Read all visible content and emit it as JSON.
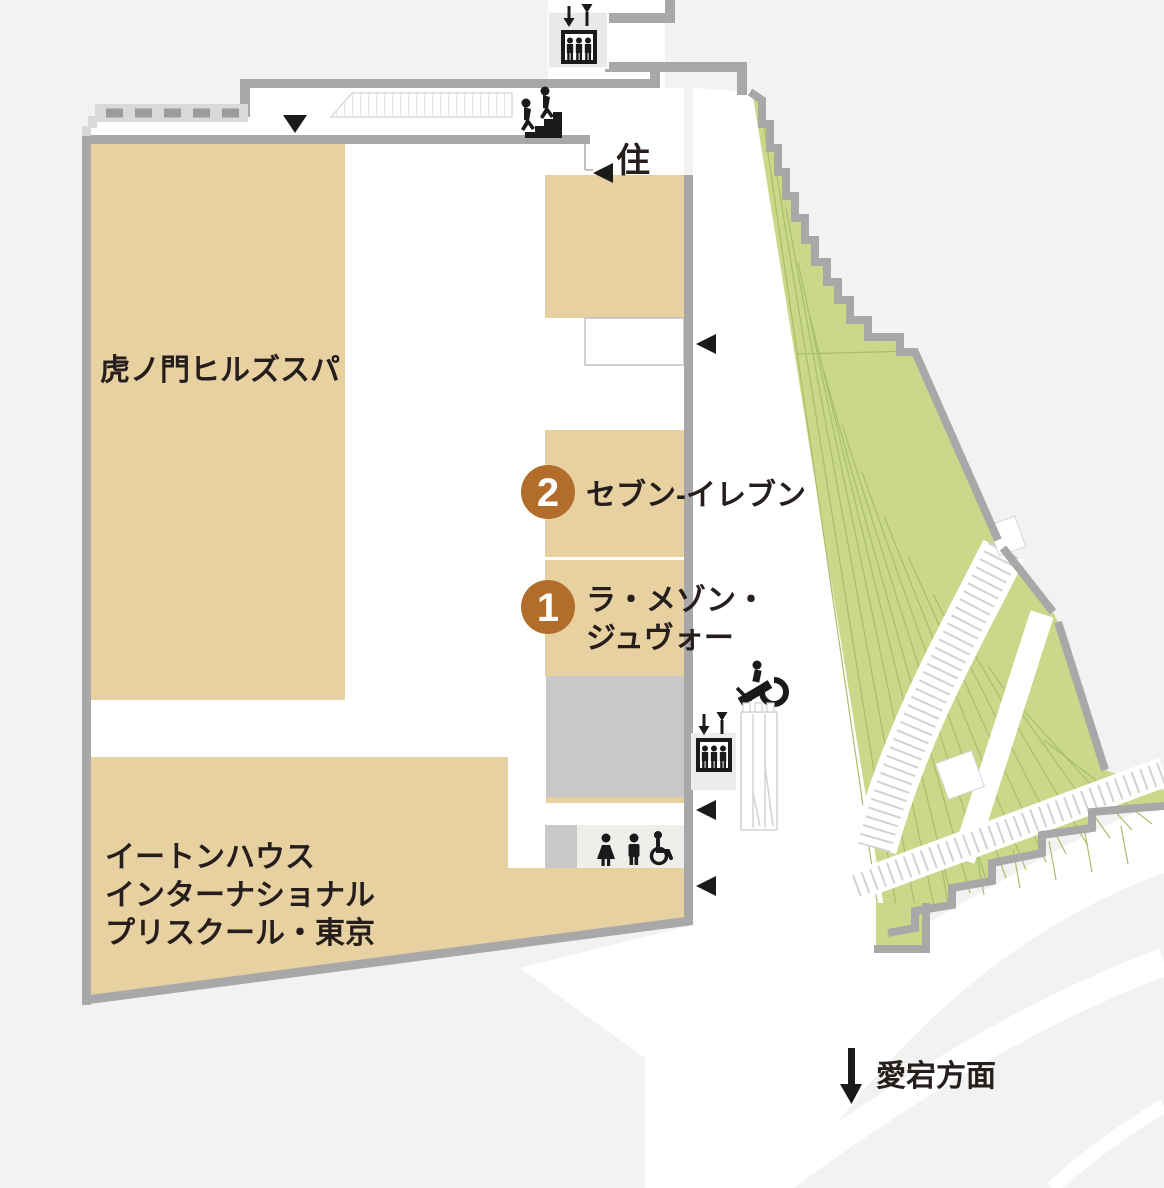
{
  "map": {
    "background_color": "#f2f2f1",
    "tenant_color": "#e8d1a1",
    "green_color": "#cad88a",
    "wall_color": "#a8a8a8",
    "marker_color": "#b26d2b",
    "text_color": "#251e1c"
  },
  "tenants": {
    "spa": {
      "name": "虎ノ門ヒルズスパ"
    },
    "preschool": {
      "name_line1": "イートンハウス",
      "name_line2": "インターナショナル",
      "name_line3": "プリスクール・東京"
    },
    "unit2": {
      "number": "2",
      "name": "セブン-イレブン"
    },
    "unit1": {
      "number": "1",
      "name_line1": "ラ・メゾン・",
      "name_line2": "ジュヴォー"
    }
  },
  "annotations": {
    "residence_label": "住",
    "direction_label": "愛宕方面"
  },
  "icons": {
    "elevator": "elevator-icon",
    "escalator": "escalator-icon",
    "stairs": "stairs-icon",
    "restroom_woman": "restroom-woman-icon",
    "restroom_man": "restroom-man-icon",
    "wheelchair": "wheelchair-icon",
    "direction_arrow": "down-arrow-icon"
  }
}
